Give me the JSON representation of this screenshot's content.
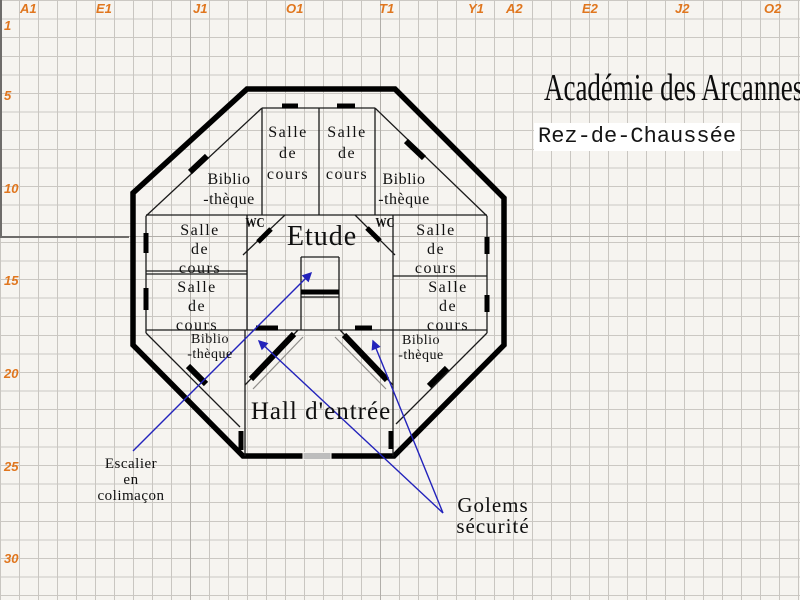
{
  "title": "Académie des Arcannes",
  "subtitle": "Rez-de-Chaussée",
  "grid": {
    "col_labels": [
      "A1",
      "E1",
      "J1",
      "O1",
      "T1",
      "Y1",
      "A2",
      "E2",
      "J2",
      "O2"
    ],
    "row_labels": [
      "1",
      "5",
      "10",
      "15",
      "20",
      "25",
      "30"
    ]
  },
  "rooms": {
    "classroom": {
      "l1": "Salle",
      "l2": "de",
      "l3": "cours"
    },
    "library": {
      "l1": "Biblio",
      "l2": "-thèque"
    },
    "study": "Etude",
    "hall": "Hall d'entrée",
    "wc": "WC"
  },
  "annotations": {
    "stairs": {
      "l1": "Escalier",
      "l2": "en",
      "l3": "colimaçon"
    },
    "golems": {
      "l1": "Golems",
      "l2": "sécurité"
    }
  },
  "colors": {
    "header_text": "#e0761e",
    "wall": "#000000",
    "arrow": "#2323bb",
    "grid_line": "#c9c6c1",
    "entrance_door": "#bdbdbd"
  }
}
